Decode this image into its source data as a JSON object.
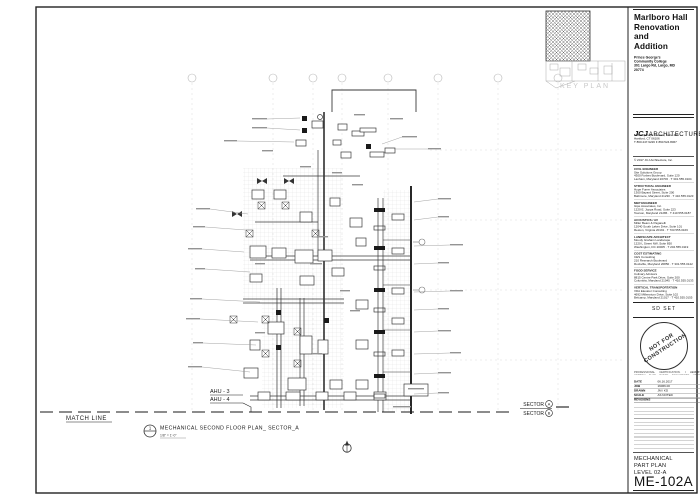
{
  "title_block": {
    "project_title_lines": [
      "Marlboro Hall",
      "Renovation and",
      "Addition"
    ],
    "client_lines": [
      "Prince George's",
      "Community College",
      "301 Largo Rd, Largo, MD",
      "20774"
    ],
    "firm": {
      "logo": "JCJ",
      "name": "ARCHITECTURE",
      "address_lines": [
        "120 Huyshope Avenue, Suite 400",
        "Hartford, CT 06106",
        "T 860.247.9226  F 860.524.8067"
      ]
    },
    "copyright": "© 2017 JCJ Architecture, Inc.",
    "consultants": [
      {
        "header": "CIVIL ENGINEER",
        "lines": [
          "Site Solutions Group",
          "4300 Forbes Boulevard, Suite 120",
          "Lanham, Maryland 20706 · T 301.555.0104"
        ]
      },
      {
        "header": "STRUCTURAL ENGINEER",
        "lines": [
          "Hope Furrer Associates",
          "1300 Bayard Street, Suite 200",
          "Baltimore, Maryland 21230 · T 410.555.0123"
        ]
      },
      {
        "header": "MEP ENGINEER",
        "lines": [
          "Gipe Associates, Inc.",
          "1220 E. Joppa Road, Suite 223",
          "Towson, Maryland 21286 · T 410.555.0187"
        ]
      },
      {
        "header": "ACOUSTICS / AV",
        "lines": [
          "Miller Beam & Paganelli",
          "12040 South Lakes Drive, Suite 101",
          "Reston, Virginia 20191 · T 703.555.0166"
        ]
      },
      {
        "header": "LANDSCAPE ARCHITECT",
        "lines": [
          "Moody Graham Landscape",
          "1220 L Street NW, Suite 850",
          "Washington, DC 20005 · T 202.555.0119"
        ]
      },
      {
        "header": "COST ESTIMATING",
        "lines": [
          "CES Consulting",
          "210 Research Boulevard",
          "Rockville, Maryland 20850 · T 301.555.0142"
        ]
      },
      {
        "header": "FOOD SERVICE",
        "lines": [
          "Culinary Advisors",
          "8815 Centre Park Drive, Suite 200",
          "Columbia, Maryland 21045 · T 410.555.0133"
        ]
      },
      {
        "header": "VERTICAL TRANSPORTATION",
        "lines": [
          "VDA Elevator Consulting",
          "4692 Millennium Drive, Suite 102",
          "Belcamp, Maryland 21017 · T 410.555.0155"
        ]
      }
    ],
    "set_label": "SD SET",
    "stamp_lines": [
      "NOT FOR",
      "CONSTRUCTION"
    ],
    "certification": "PROFESSIONAL CERTIFICATION. I HEREBY CERTIFY THAT THESE DOCUMENTS WERE PREPARED OR APPROVED BY ME, AND THAT I AM A DULY LICENSED ARCHITECT UNDER THE LAWS OF THE STATE OF MARYLAND.",
    "fields": [
      {
        "label": "DATE",
        "value": "06.16.2017"
      },
      {
        "label": "JOB",
        "value": "16066.00"
      },
      {
        "label": "DRAWN",
        "value": "JM / KD"
      },
      {
        "label": "SCALE",
        "value": "AS NOTED"
      }
    ],
    "revisions_label": "REVISIONS",
    "sheet_title_lines": [
      "MECHANICAL",
      "PART PLAN",
      "LEVEL 02-A"
    ],
    "sheet_number": "ME-102A"
  },
  "key_plan": {
    "label": "KEY PLAN"
  },
  "plan": {
    "ahu_labels": [
      "AHU - 3",
      "AHU - 4"
    ],
    "match_line_label": "MATCH LINE",
    "sector_word": "SECTOR",
    "sector_letters": [
      "A",
      "B"
    ],
    "caption": {
      "detail_number": "1",
      "title": "MECHANICAL SECOND FLOOR PLAN_ SECTOR_A",
      "scale": "1/8\" = 1'-0\""
    }
  },
  "colors": {
    "line": "#1a1a1a",
    "faint_grid": "#dcdcdc",
    "keyplan_text": "#c8c8c8"
  }
}
